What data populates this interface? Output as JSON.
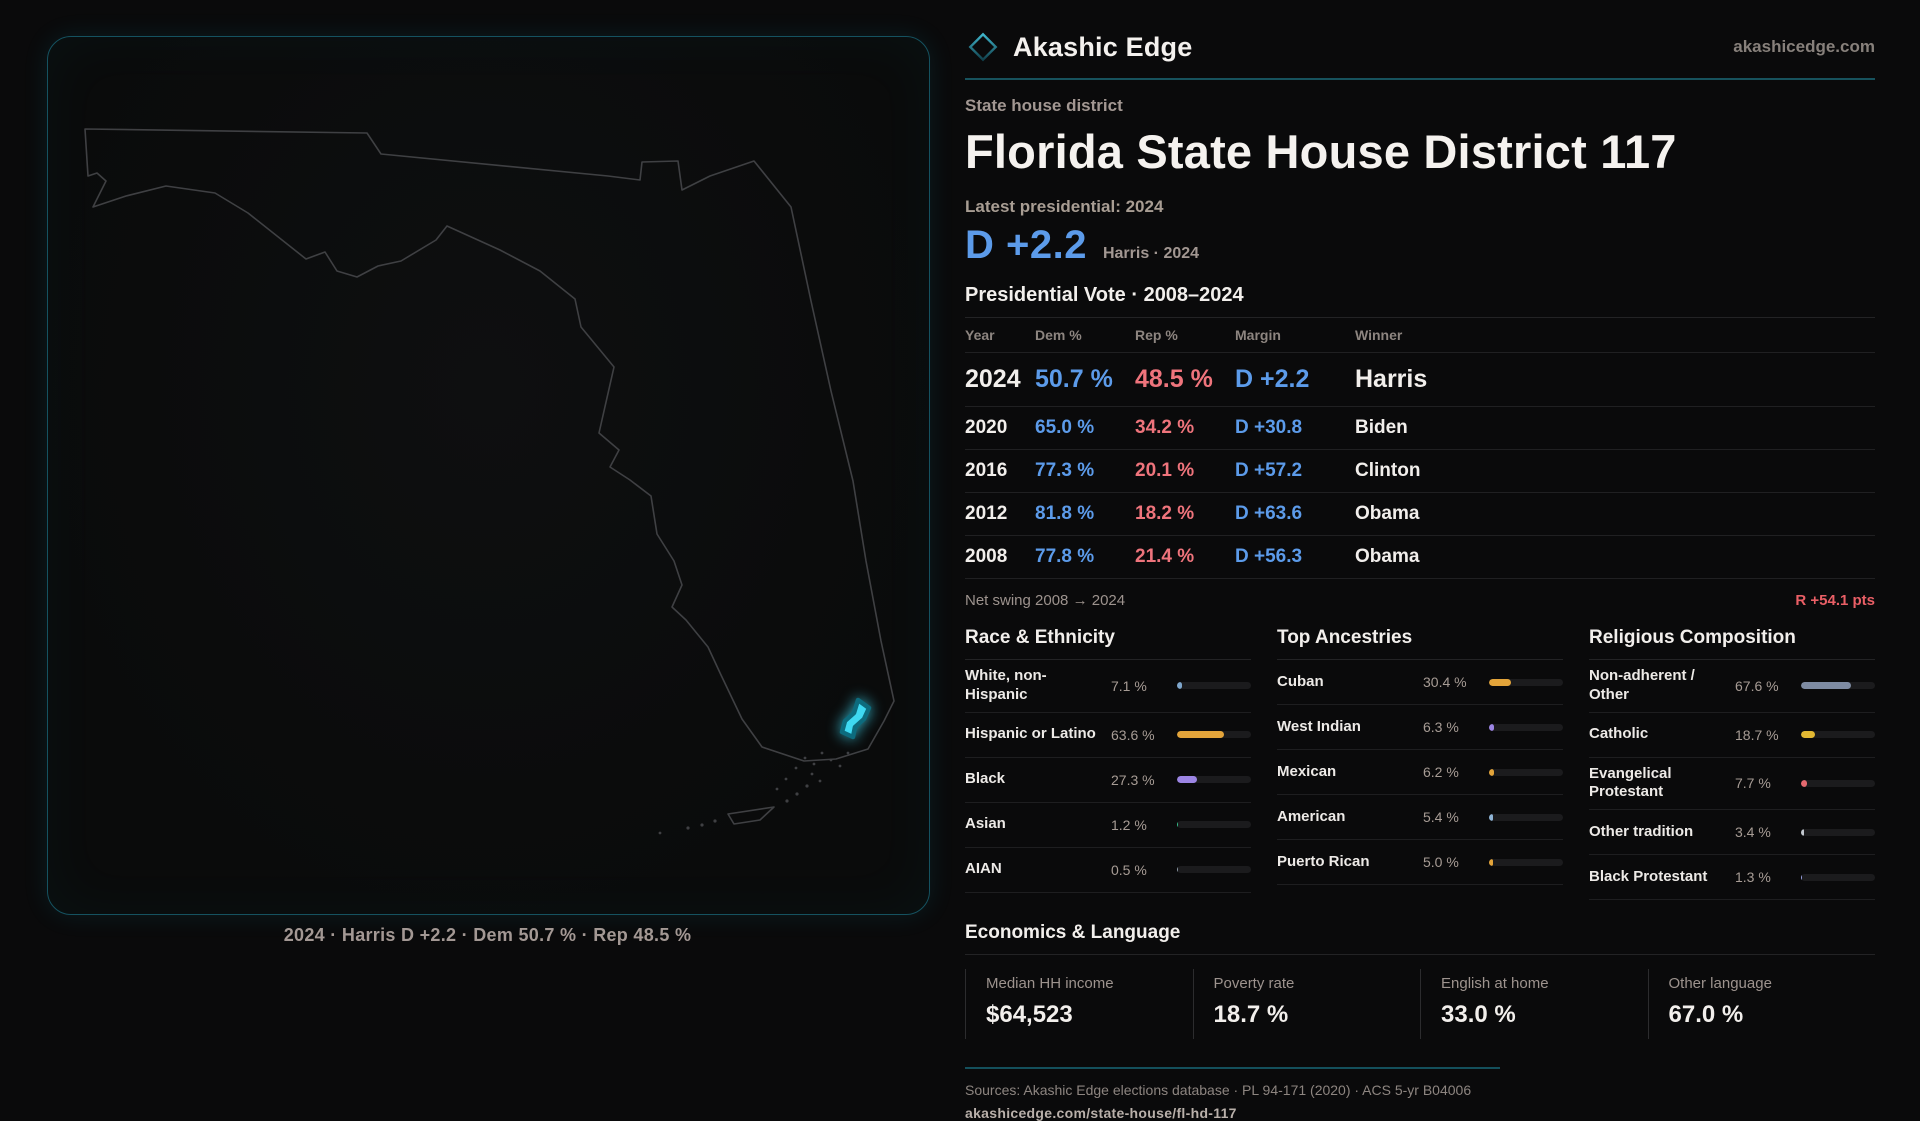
{
  "brand": {
    "name": "Akashic Edge",
    "domain": "akashicedge.com",
    "logo_icon": "diamond-outline-icon",
    "accent_teal": "#17525d"
  },
  "page": {
    "kicker": "State house district",
    "title": "Florida State House District 117",
    "latest_label": "Latest presidential: 2024",
    "headline_margin": "D +2.2",
    "headline_context": "Harris · 2024",
    "dem_color": "#5c9bea",
    "rep_color": "#ef747c"
  },
  "map": {
    "caption": "2024 · Harris D +2.2 · Dem 50.7 % · Rep 48.5 %",
    "highlight_color": "#3fd9f2",
    "outline_color": "#3f4043"
  },
  "vote_table": {
    "title": "Presidential Vote · 2008–2024",
    "columns": [
      "Year",
      "Dem %",
      "Rep %",
      "Margin",
      "Winner"
    ],
    "rows": [
      {
        "year": "2024",
        "dem": "50.7 %",
        "rep": "48.5 %",
        "margin": "D +2.2",
        "winner": "Harris",
        "featured": true
      },
      {
        "year": "2020",
        "dem": "65.0 %",
        "rep": "34.2 %",
        "margin": "D +30.8",
        "winner": "Biden",
        "featured": false
      },
      {
        "year": "2016",
        "dem": "77.3 %",
        "rep": "20.1 %",
        "margin": "D +57.2",
        "winner": "Clinton",
        "featured": false
      },
      {
        "year": "2012",
        "dem": "81.8 %",
        "rep": "18.2 %",
        "margin": "D +63.6",
        "winner": "Obama",
        "featured": false
      },
      {
        "year": "2008",
        "dem": "77.8 %",
        "rep": "21.4 %",
        "margin": "D +56.3",
        "winner": "Obama",
        "featured": false
      }
    ],
    "net_swing_label": "Net swing 2008 → 2024",
    "net_swing_value": "R +54.1 pts"
  },
  "sections": {
    "race": {
      "title": "Race & Ethnicity",
      "rows": [
        {
          "label": "White, non-Hispanic",
          "value": "7.1 %",
          "pct": 7.1,
          "color": "#7ea6cc"
        },
        {
          "label": "Hispanic or Latino",
          "value": "63.6 %",
          "pct": 63.6,
          "color": "#e3a43a"
        },
        {
          "label": "Black",
          "value": "27.3 %",
          "pct": 27.3,
          "color": "#9c85e4"
        },
        {
          "label": "Asian",
          "value": "1.2 %",
          "pct": 1.2,
          "color": "#35c08a"
        },
        {
          "label": "AIAN",
          "value": "0.5 %",
          "pct": 0.5,
          "color": "#8d99a6"
        }
      ]
    },
    "ancestries": {
      "title": "Top Ancestries",
      "rows": [
        {
          "label": "Cuban",
          "value": "30.4 %",
          "pct": 30.4,
          "color": "#e3a43a"
        },
        {
          "label": "West Indian",
          "value": "6.3 %",
          "pct": 6.3,
          "color": "#9c85e4"
        },
        {
          "label": "Mexican",
          "value": "6.2 %",
          "pct": 6.2,
          "color": "#e3a43a"
        },
        {
          "label": "American",
          "value": "5.4 %",
          "pct": 5.4,
          "color": "#8fb4d6"
        },
        {
          "label": "Puerto Rican",
          "value": "5.0 %",
          "pct": 5.0,
          "color": "#e3a43a"
        }
      ]
    },
    "religion": {
      "title": "Religious Composition",
      "rows": [
        {
          "label": "Non-adherent / Other",
          "value": "67.6 %",
          "pct": 67.6,
          "color": "#7e8ba2"
        },
        {
          "label": "Catholic",
          "value": "18.7 %",
          "pct": 18.7,
          "color": "#e2b832"
        },
        {
          "label": "Evangelical Protestant",
          "value": "7.7 %",
          "pct": 7.7,
          "color": "#e4696f"
        },
        {
          "label": "Other tradition",
          "value": "3.4 %",
          "pct": 3.4,
          "color": "#c3c8cf"
        },
        {
          "label": "Black Protestant",
          "value": "1.3 %",
          "pct": 1.3,
          "color": "#9aa2e6"
        }
      ]
    }
  },
  "economics": {
    "title": "Economics & Language",
    "stats": [
      {
        "label": "Median HH income",
        "value": "$64,523"
      },
      {
        "label": "Poverty rate",
        "value": "18.7 %"
      },
      {
        "label": "English at home",
        "value": "33.0 %"
      },
      {
        "label": "Other language",
        "value": "67.0 %"
      }
    ]
  },
  "footer": {
    "sources": "Sources: Akashic Edge elections database · PL 94-171 (2020) · ACS 5-yr B04006",
    "permalink": "akashicedge.com/state-house/fl-hd-117"
  },
  "chart_data": [
    {
      "type": "table",
      "title": "Presidential Vote · 2008–2024",
      "columns": [
        "Year",
        "Dem %",
        "Rep %",
        "Margin",
        "Winner"
      ],
      "rows": [
        [
          "2024",
          50.7,
          48.5,
          "D +2.2",
          "Harris"
        ],
        [
          "2020",
          65.0,
          34.2,
          "D +30.8",
          "Biden"
        ],
        [
          "2016",
          77.3,
          20.1,
          "D +57.2",
          "Clinton"
        ],
        [
          "2012",
          81.8,
          18.2,
          "D +63.6",
          "Obama"
        ],
        [
          "2008",
          77.8,
          21.4,
          "D +56.3",
          "Obama"
        ]
      ],
      "note": "Net swing 2008 → 2024: R +54.1 pts"
    },
    {
      "type": "bar",
      "title": "Race & Ethnicity",
      "categories": [
        "White, non-Hispanic",
        "Hispanic or Latino",
        "Black",
        "Asian",
        "AIAN"
      ],
      "values": [
        7.1,
        63.6,
        27.3,
        1.2,
        0.5
      ],
      "unit": "%",
      "xlim": [
        0,
        100
      ],
      "orientation": "horizontal",
      "grid": false,
      "legend": "none"
    },
    {
      "type": "bar",
      "title": "Top Ancestries",
      "categories": [
        "Cuban",
        "West Indian",
        "Mexican",
        "American",
        "Puerto Rican"
      ],
      "values": [
        30.4,
        6.3,
        6.2,
        5.4,
        5.0
      ],
      "unit": "%",
      "xlim": [
        0,
        100
      ],
      "orientation": "horizontal",
      "grid": false,
      "legend": "none"
    },
    {
      "type": "bar",
      "title": "Religious Composition",
      "categories": [
        "Non-adherent / Other",
        "Catholic",
        "Evangelical Protestant",
        "Other tradition",
        "Black Protestant"
      ],
      "values": [
        67.6,
        18.7,
        7.7,
        3.4,
        1.3
      ],
      "unit": "%",
      "xlim": [
        0,
        100
      ],
      "orientation": "horizontal",
      "grid": false,
      "legend": "none"
    },
    {
      "type": "table",
      "title": "Economics & Language",
      "columns": [
        "Median HH income",
        "Poverty rate",
        "English at home",
        "Other language"
      ],
      "rows": [
        [
          "$64,523",
          "18.7 %",
          "33.0 %",
          "67.0 %"
        ]
      ]
    }
  ]
}
